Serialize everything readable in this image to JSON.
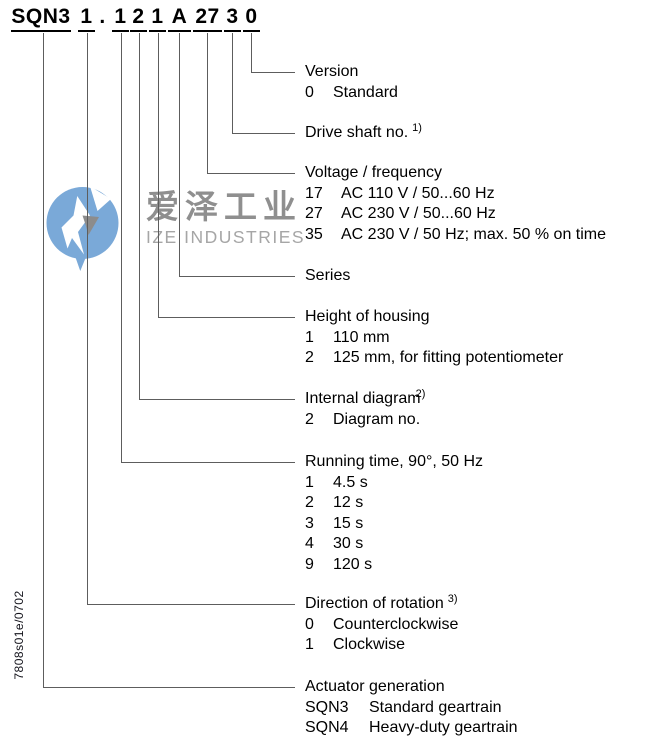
{
  "product_code": {
    "full": "SQN3 1 . 1 2 1 A 27 3 0",
    "segments": [
      {
        "text": "SQN3",
        "underlined": true
      },
      {
        "text": "1",
        "underlined": true
      },
      {
        "text": ".",
        "underlined": false
      },
      {
        "text": "1",
        "underlined": true
      },
      {
        "text": "2",
        "underlined": true
      },
      {
        "text": "1",
        "underlined": true
      },
      {
        "text": "A",
        "underlined": true
      },
      {
        "text": "27",
        "underlined": true
      },
      {
        "text": "3",
        "underlined": true
      },
      {
        "text": "0",
        "underlined": true
      }
    ]
  },
  "sections": [
    {
      "title": "Version",
      "sup": "",
      "sup_style": "",
      "items": [
        {
          "code": "0",
          "label": "Standard"
        }
      ]
    },
    {
      "title": "Drive shaft no.",
      "sup": "1)",
      "sup_style": "spaced",
      "items": []
    },
    {
      "title": "Voltage / frequency",
      "sup": "",
      "sup_style": "",
      "items": [
        {
          "code": "17",
          "label": "AC 110 V / 50...60 Hz"
        },
        {
          "code": "27",
          "label": "AC 230 V / 50...60 Hz"
        },
        {
          "code": "35",
          "label": "AC 230 V / 50 Hz; max. 50 % on time"
        }
      ]
    },
    {
      "title": "Series",
      "sup": "",
      "sup_style": "",
      "items": []
    },
    {
      "title": "Height of housing",
      "sup": "",
      "sup_style": "",
      "items": [
        {
          "code": "1",
          "label": "110 mm"
        },
        {
          "code": "2",
          "label": "125 mm, for fitting potentiometer"
        }
      ]
    },
    {
      "title": "Internal diagram",
      "sup": "2)",
      "sup_style": "tight",
      "items": [
        {
          "code": "2",
          "label": "Diagram no."
        }
      ]
    },
    {
      "title": "Running time, 90°, 50 Hz",
      "sup": "",
      "sup_style": "",
      "items": [
        {
          "code": "1",
          "label": "4.5 s"
        },
        {
          "code": "2",
          "label": "12 s"
        },
        {
          "code": "3",
          "label": "15 s"
        },
        {
          "code": "4",
          "label": "30 s"
        },
        {
          "code": "9",
          "label": "120 s"
        }
      ]
    },
    {
      "title": "Direction of rotation",
      "sup": "3)",
      "sup_style": "spaced",
      "items": [
        {
          "code": "0",
          "label": "Counterclockwise"
        },
        {
          "code": "1",
          "label": "Clockwise"
        }
      ]
    },
    {
      "title": "Actuator generation",
      "sup": "",
      "sup_style": "",
      "items": [
        {
          "code": "SQN3",
          "label": "Standard geartrain"
        },
        {
          "code": "SQN4",
          "label": "Heavy-duty geartrain"
        }
      ]
    }
  ],
  "watermark": {
    "chinese": "爱泽工业",
    "english": "IZE INDUSTRIES"
  },
  "doc_ref": "7808s01e/0702",
  "colors": {
    "line": "#5d5d5d",
    "underline": "#000000",
    "watermark_blue": "#7aa9d8",
    "watermark_gray": "#8f8f8f",
    "watermark_light_gray": "#a6a6a6"
  }
}
